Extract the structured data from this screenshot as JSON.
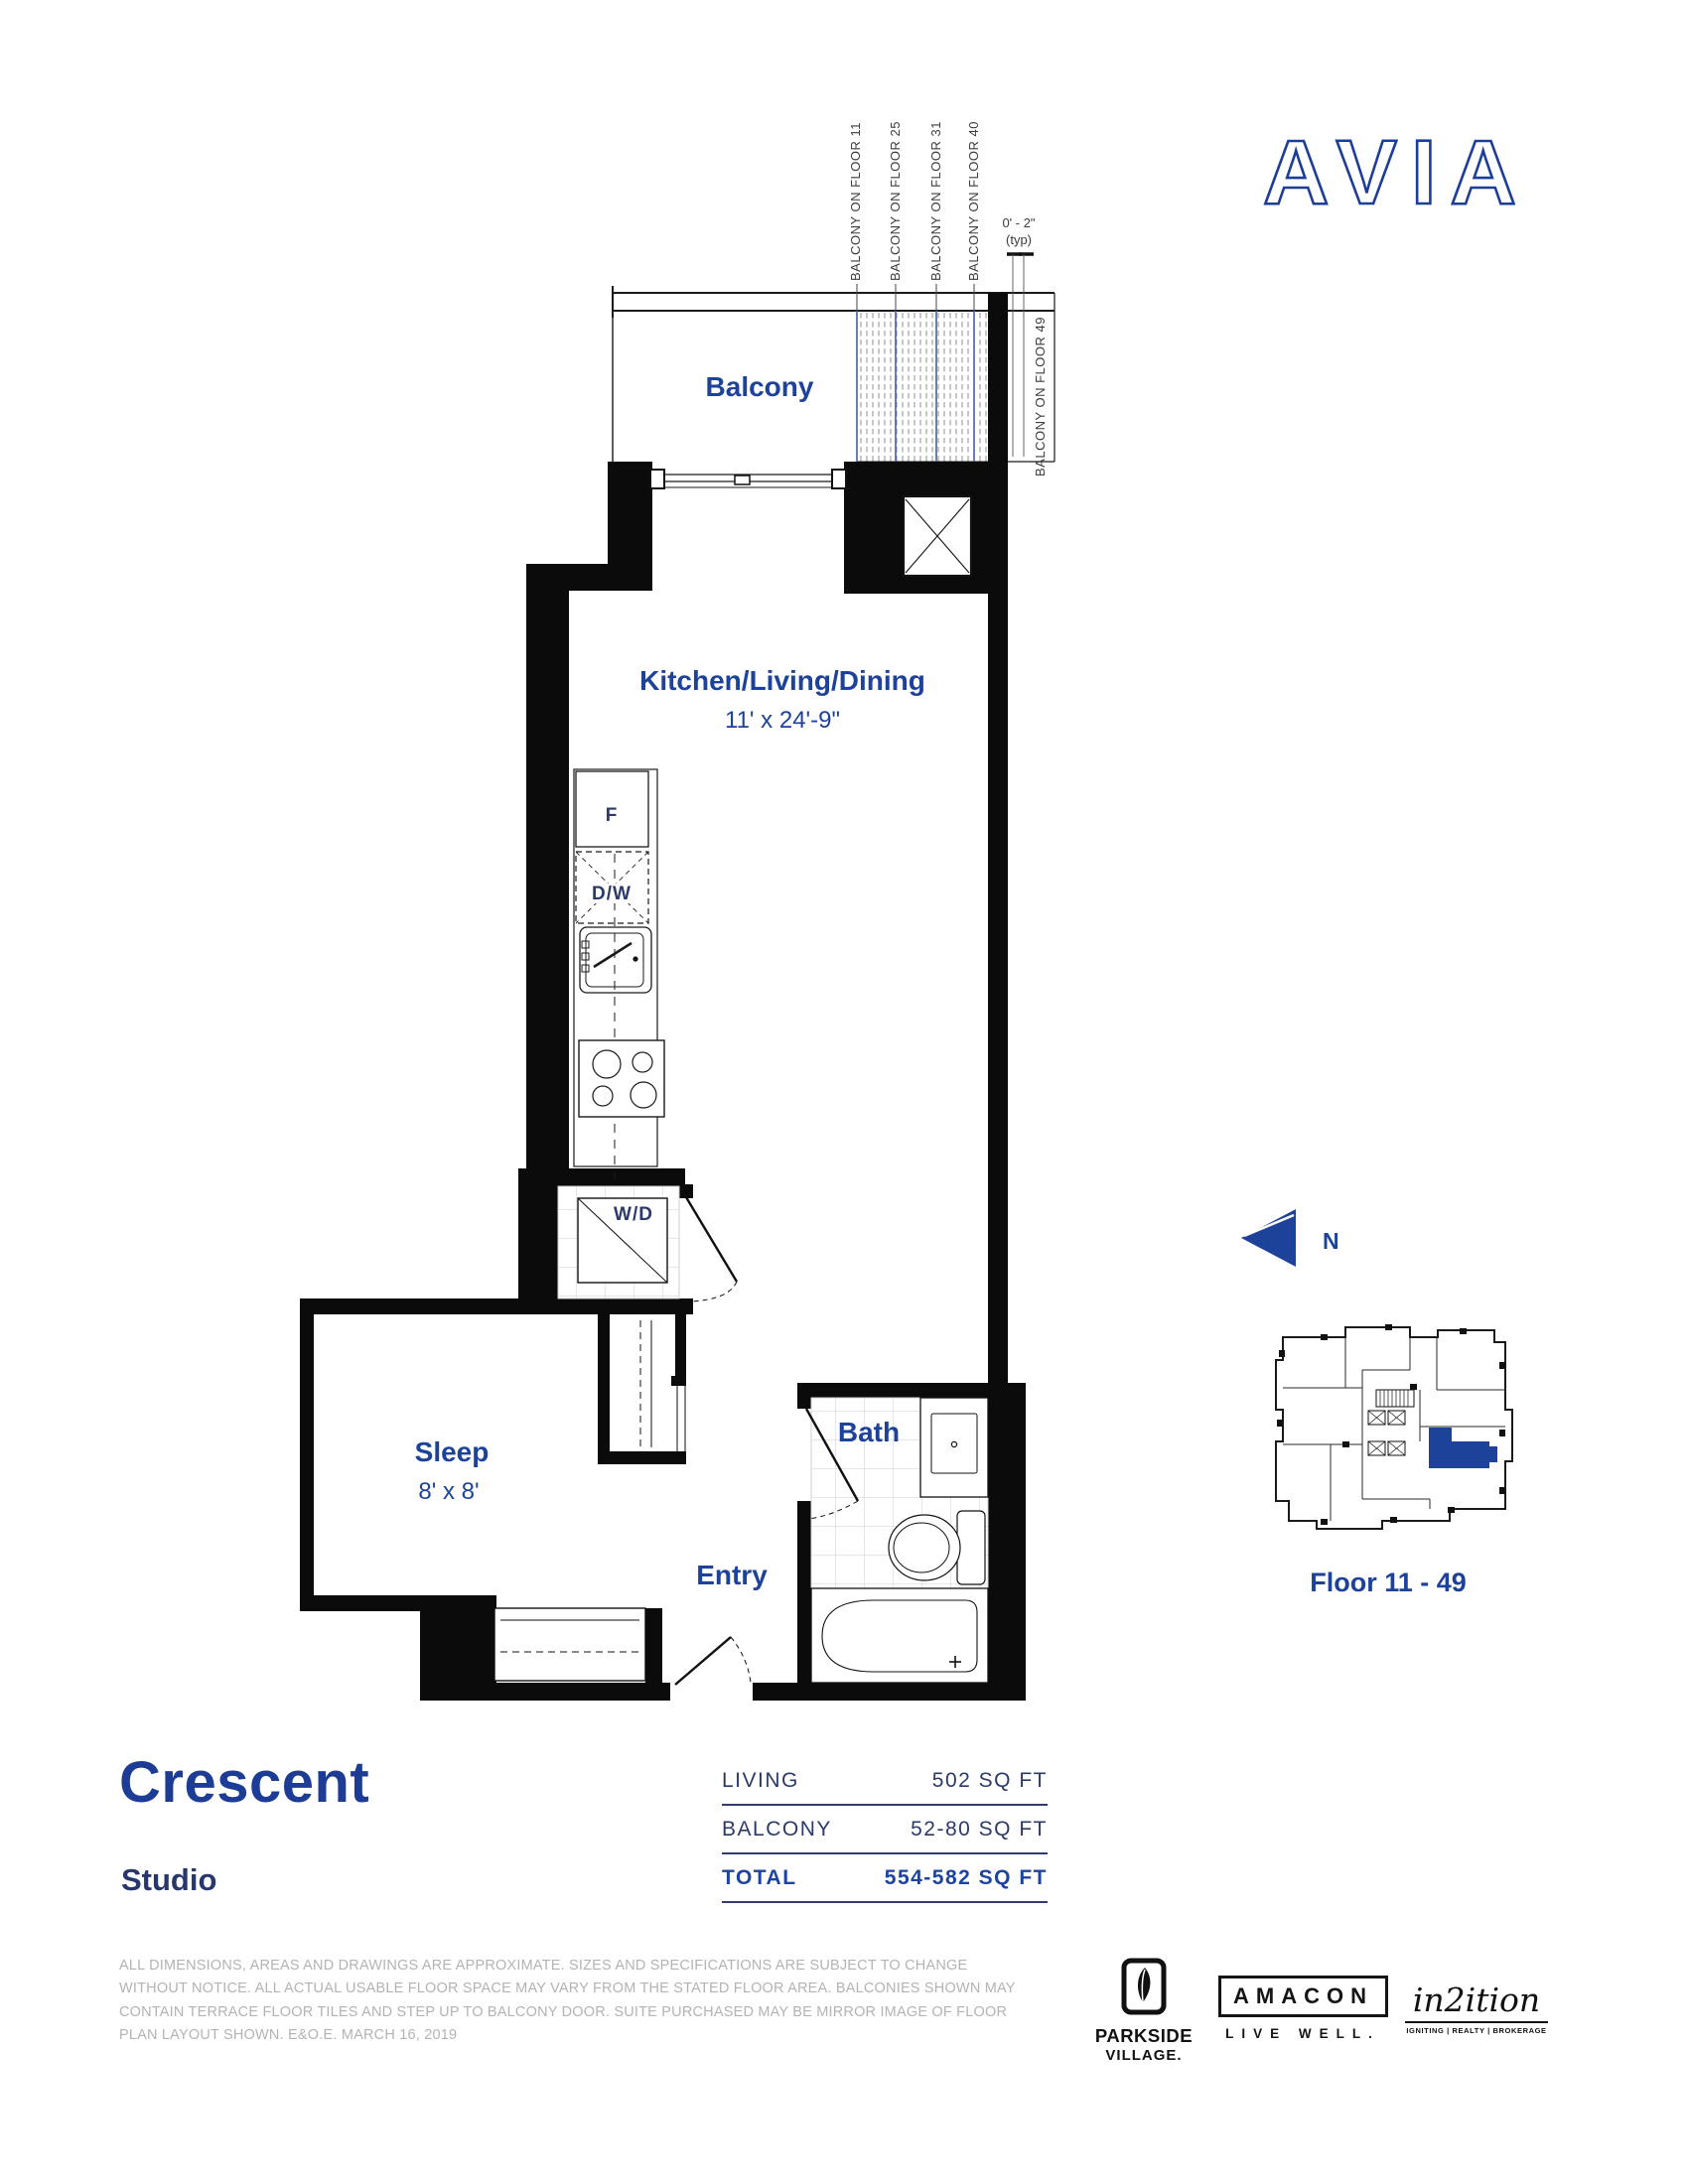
{
  "colors": {
    "accent_blue": "#1D4299",
    "heading_blue": "#1C3C96",
    "navy_text": "#2B3A68",
    "total_blue": "#1D44A3",
    "wall_black": "#0B0B0B",
    "disclaimer_gray": "#B3B3B3"
  },
  "brand": {
    "logo_text": "AVIA"
  },
  "plan": {
    "labels": {
      "balcony": "Balcony",
      "kitchen": "Kitchen/Living/Dining",
      "kitchen_dims": "11' x 24'-9\"",
      "sleep": "Sleep",
      "sleep_dims": "8' x 8'",
      "bath": "Bath",
      "entry": "Entry",
      "fridge": "F",
      "dishwasher": "D/W",
      "washer_dryer": "W/D"
    },
    "balcony_annotations": {
      "floor11": "BALCONY ON FLOOR 11",
      "floor25": "BALCONY ON FLOOR 25",
      "floor31": "BALCONY ON FLOOR 31",
      "floor40": "BALCONY ON FLOOR 40",
      "floor49": "BALCONY ON FLOOR 49",
      "dim_line1": "0' - 2\"",
      "dim_line2": "(typ)"
    }
  },
  "keyplan": {
    "north_label": "N",
    "caption": "Floor 11 - 49"
  },
  "summary": {
    "name": "Crescent",
    "suite_type": "Studio",
    "table": {
      "rows": [
        {
          "label": "LIVING",
          "value": "502 SQ FT"
        },
        {
          "label": "BALCONY",
          "value": "52-80 SQ FT"
        },
        {
          "label": "TOTAL",
          "value": "554-582 SQ FT"
        }
      ]
    }
  },
  "disclaimer": {
    "lines": [
      "ALL DIMENSIONS, AREAS AND DRAWINGS ARE APPROXIMATE. SIZES AND SPECIFICATIONS ARE SUBJECT TO CHANGE",
      "WITHOUT NOTICE. ALL ACTUAL USABLE FLOOR SPACE MAY VARY FROM THE STATED FLOOR AREA. BALCONIES SHOWN MAY",
      "CONTAIN TERRACE FLOOR TILES AND STEP UP TO BALCONY DOOR. SUITE PURCHASED MAY BE MIRROR IMAGE OF FLOOR",
      "PLAN LAYOUT SHOWN. E&O.E. MARCH 16, 2019"
    ]
  },
  "footer": {
    "parkside": {
      "line1": "PARKSIDE",
      "line2": "VILLAGE."
    },
    "amacon": {
      "name": "AMACON",
      "tagline": "LIVE WELL."
    },
    "in2ition": {
      "script": "in2ition",
      "tagline": "IGNITING | REALTY | BROKERAGE"
    }
  }
}
